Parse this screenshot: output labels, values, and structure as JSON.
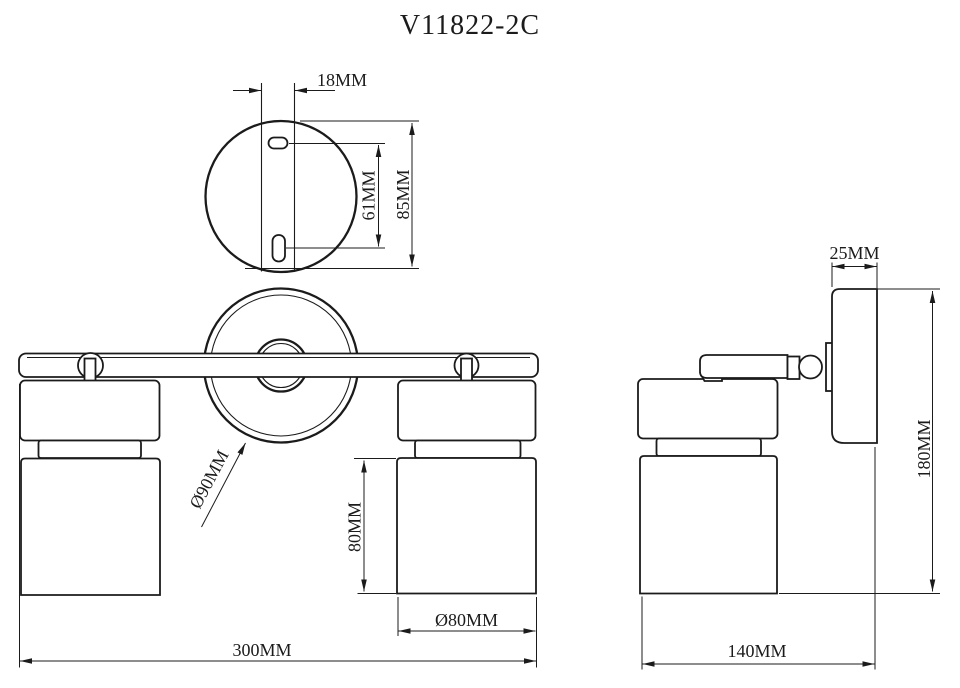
{
  "title": "V11822-2C",
  "drawing_type": "lamp dimensional drawing",
  "unit": "MM",
  "colors": {
    "line": "#1b1b1b",
    "background": "#ffffff"
  },
  "views": {
    "top": {
      "name": "mounting-plate-top-view",
      "dimensions": {
        "slot_offset": "18MM",
        "slot_spacing": "61MM",
        "plate_height": "85MM"
      }
    },
    "front": {
      "name": "front-view",
      "dimensions": {
        "backplate_diameter": "Ø90MM",
        "shade_height": "80MM",
        "shade_diameter": "Ø80MM",
        "overall_width": "300MM"
      }
    },
    "side": {
      "name": "side-view",
      "dimensions": {
        "wall_plate_depth": "25MM",
        "overall_height": "180MM",
        "overall_depth": "140MM"
      }
    }
  }
}
